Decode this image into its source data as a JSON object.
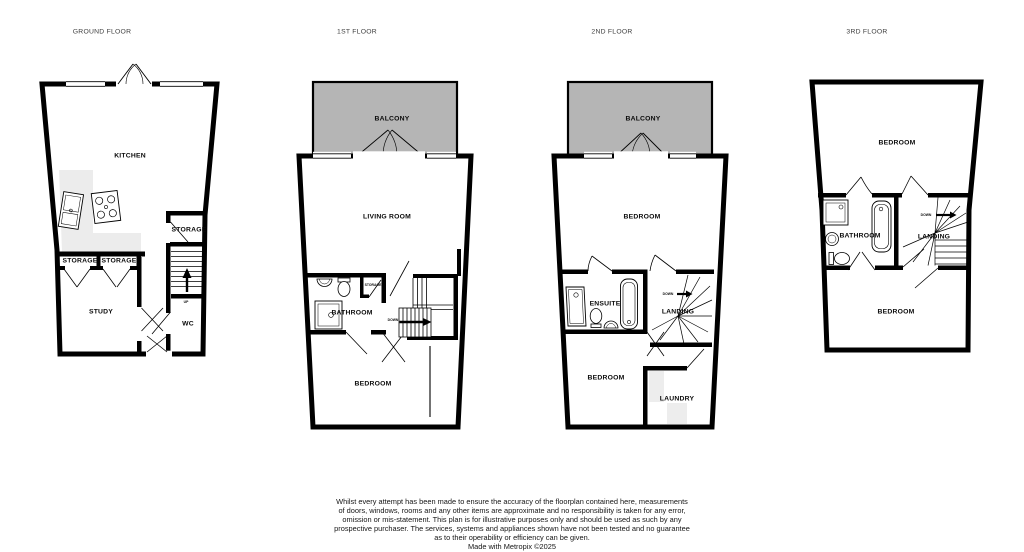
{
  "colors": {
    "wall": "#000000",
    "balcony_fill": "#b5b5b5",
    "counter_fill": "#ececec",
    "appliance_fill": "#ededed",
    "background": "#ffffff"
  },
  "floors": [
    {
      "title": "GROUND FLOOR",
      "labels": {
        "kitchen": "KITCHEN",
        "storage_main": "STORAGE",
        "storage_left": "STORAGE",
        "storage_right": "STORAGE",
        "study": "STUDY",
        "wc": "WC",
        "up": "UP"
      }
    },
    {
      "title": "1ST FLOOR",
      "labels": {
        "balcony": "BALCONY",
        "living_room": "LIVING ROOM",
        "storage": "STORAGE",
        "bathroom": "BATHROOM",
        "down": "DOWN",
        "bedroom": "BEDROOM"
      }
    },
    {
      "title": "2ND FLOOR",
      "labels": {
        "balcony": "BALCONY",
        "bedroom_top": "BEDROOM",
        "ensuite": "ENSUITE",
        "landing": "LANDING",
        "down": "DOWN",
        "bedroom_bottom": "BEDROOM",
        "laundry": "LAUNDRY"
      }
    },
    {
      "title": "3RD FLOOR",
      "labels": {
        "bedroom_top": "BEDROOM",
        "bathroom": "BATHROOM",
        "landing": "LANDING",
        "down": "DOWN",
        "bedroom_bottom": "BEDROOM"
      }
    }
  ],
  "footer": {
    "lines": [
      "Whilst every attempt has been made to ensure the accuracy of the floorplan contained here, measurements",
      "of doors, windows, rooms and any other items are approximate and no responsibility is taken for any error,",
      "omission or mis-statement. This plan is for illustrative purposes only and should be used as such by any",
      "prospective purchaser. The services, systems and appliances shown have not been tested and no guarantee",
      "as to their operability or efficiency can be given."
    ],
    "credit": "Made with Metropix ©2025"
  }
}
